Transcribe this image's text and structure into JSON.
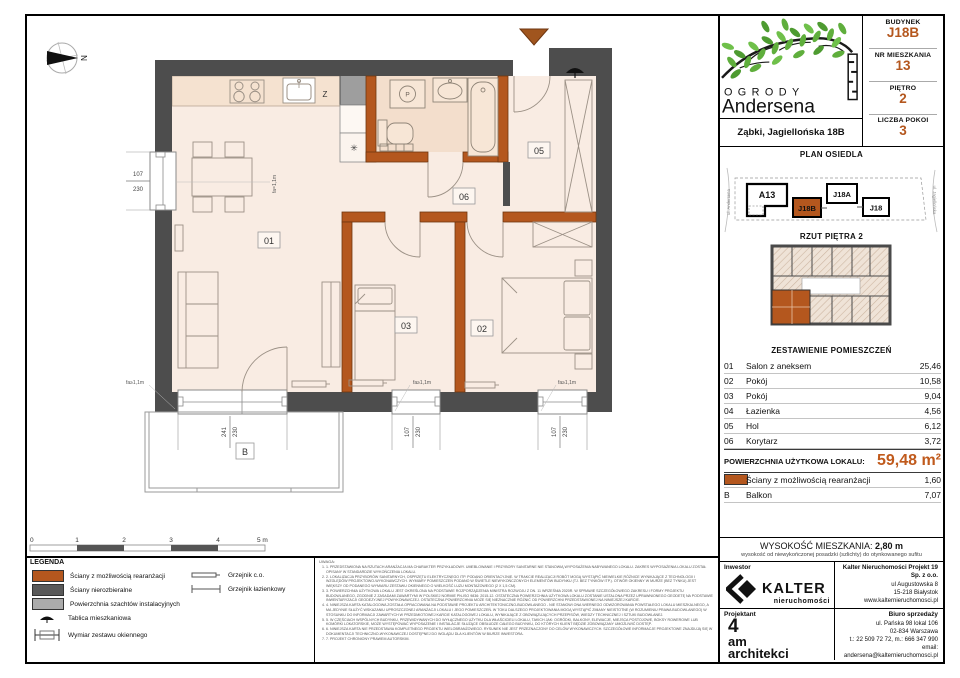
{
  "colors": {
    "accent_orange": "#B4571E",
    "total_orange": "#C05A1C",
    "wall_dark": "#4D4D4D",
    "shaft_gray": "#9E9E9E",
    "floor": "#F9ECE3",
    "bathroom_floor": "#F3DECC",
    "leaf_green": "#5FAE3C"
  },
  "header": {
    "budynek_label": "BUDYNEK",
    "budynek_value": "J18B",
    "nr_label": "NR MIESZKANIA",
    "nr_value": "13",
    "pietro_label": "PIĘTRO",
    "pietro_value": "2",
    "pokoi_label": "LICZBA POKOI",
    "pokoi_value": "3"
  },
  "brand": {
    "line1": "OGRODY",
    "line2": "Andersena",
    "address": "Ząbki, Jagiellońska 18B"
  },
  "site_plan": {
    "title": "PLAN OSIEDLA",
    "street_left": "ul. Andersena",
    "street_right": "ul. Jagiellońska",
    "buildings": [
      "A13",
      "J18B",
      "J18A",
      "J18"
    ],
    "highlighted": "J18B"
  },
  "floor_thumb": {
    "title": "RZUT PIĘTRA 2"
  },
  "rooms_table": {
    "title": "ZESTAWIENIE POMIESZCZEŃ",
    "rows": [
      {
        "no": "01",
        "name": "Salon z aneksem",
        "area": "25,46"
      },
      {
        "no": "02",
        "name": "Pokój",
        "area": "10,58"
      },
      {
        "no": "03",
        "name": "Pokój",
        "area": "9,04"
      },
      {
        "no": "04",
        "name": "Łazienka",
        "area": "4,56"
      },
      {
        "no": "05",
        "name": "Hol",
        "area": "6,12"
      },
      {
        "no": "06",
        "name": "Korytarz",
        "area": "3,72"
      }
    ],
    "total_label": "POWIERZCHNIA UŻYTKOWA LOKALU:",
    "total_value": "59,48 m²",
    "extra": [
      {
        "no": "",
        "name": "Ściany z możliwością rearanżacji",
        "area": "1,60"
      },
      {
        "no": "B",
        "name": "Balkon",
        "area": "7,07"
      }
    ]
  },
  "height_info": {
    "label": "WYSOKOŚĆ MIESZKANIA:",
    "value": "2,80 m",
    "note": "wysokość od niewykończonej posadzki (szlichty) do otynkowanego sufitu"
  },
  "inwestor": {
    "label": "Inwestor",
    "brand": "KALTER",
    "brand_sub": "nieruchomości",
    "company": "Kalter Nieruchomości Projekt 19 Sp. z o.o.",
    "address1": "ul Augustowska 8",
    "address2": "15-218 Białystok",
    "web": "www.kalternieruchomosci.pl"
  },
  "projektant": {
    "label": "Projektant",
    "line1": "4",
    "line2": "am",
    "line3": "architekci"
  },
  "sales": {
    "label": "Biuro sprzedaży",
    "address1": "ul. Pańska 98 lokal 106",
    "address2": "02-834 Warszawa",
    "phone": "t.: 22 509 72 72, m.: 666 347 990",
    "email": "email: andersena@kalternieruchomosci.pl"
  },
  "legend": {
    "title": "LEGENDA",
    "items": [
      "Ściany z możliwością rearanżacji",
      "Ściany nierozbieralne",
      "Powierzchnia szachtów instalacyjnych",
      "Tablica mieszkaniowa",
      "Wymiar zestawu okiennego"
    ],
    "items2": [
      "Grzejnik c.o.",
      "Grzejnik łazienkowy"
    ]
  },
  "scale_bar": {
    "labels": [
      "0",
      "1",
      "2",
      "3",
      "4",
      "5 m"
    ]
  },
  "notes": {
    "title": "UWAGA:",
    "items": [
      "1.  PRZEDSTAWIONA NA RZUTACH ARANŻACJA MA CHARAKTER PRZYKŁADOWY. UMEBLOWANIE I PRZYBORY SANITARNE NIE STANOWIĄ WYPOSAŻENIA NABYWANEGO LOKALU. ZAKRES WYPOSAŻENIA LOKALU ZOSTAŁ OPISANY W STANDARDZIE WYKOŃCZENIA LOKALU.",
      "2.  LOKALIZACJA PRZYBORÓW SANITARNYCH, OSPRZĘTU ELEKTRYCZNEGO ITP. PODANO ORIENTACYJNIE. W TRAKCIE REALIZACJI ROBÓT MOGĄ WYSTĄPIĆ NIEWIELKIE RÓŻNICE WYNIKAJĄCE Z TECHNOLOGII I WZGLĘDÓW PROJEKTOWO-WYKONAWCZYCH. WYMIARY POMIESZCZEŃ PODANO W ŚWIETLE NIEWYKOŃCZONYCH ELEMENTÓW BUDYNKU (TJ. BEZ TYNKÓW ITP.). OTWÓR OKIENNY W MURZE (BEZ TYNKU) JEST WIĘKSZY OD PODANEGO WYMIARU ZESTAWU OKIENNEGO O WIELKOŚĆ LUZU MONTAŻOWEGO (2 X 1,5 CM).",
      "3.  POWIERZCHNIA UŻYTKOWA LOKALU JEST OKREŚLONA NA PODSTAWIE ROZPORZĄDZENIA MINISTRA ROZWOJU Z DN. 11 WRZEŚNIA 2020R. W SPRAWIE SZCZEGÓŁOWEGO ZAKRESU I FORMY PROJEKTU BUDOWLANEGO, ZGODNIE Z ZASADAMI ZAWARTYMI W POLSKIEJ NORMIE PN-ISO 9836: 2015-12. OSTATECZNA POWIERZCHNIA UŻYTKOWA LOKALU ZOSTANIE USTALONA PRZEZ UPRAWNIONEGO GEODETĘ NA PODSTAWIE INWENTARYZACJI GEODEZYJNEJ POWYKONAWCZEJ. OSTATECZNA POWIERZCHNIA MOŻE SIĘ NIEZNACZNIE RÓŻNIĆ OD POWIERZCHNI PRZEDSTAWIONEJ NA NINIEJSZEJ KARCIE.",
      "4.  NINIEJSZA KARTA KATALOGOWA ZOSTAŁA OPRACOWANA NA PODSTAWIE PROJEKTU ARCHITEKTONICZNO-BUDOWLANEGO - NIE STANOWI ONA WIERNEGO ODWZOROWANIA POWSTAŁEGO LOKALU MIESZKALNEGO, A MA JEDYNIE SŁUŻYĆ WSKAZANIU UPROSZCZONEJ ARANŻACJI LOKALU I JEGO POMIESZCZEŃ. W TOKU DALSZEGO PROJEKTOWANIA MOGĄ WYSTĄPIĆ ZMIANY NIEISTOTNE (W ROZUMIENIU PRAWA BUDOWLANEGO) W STOSUNKU DO INFORMACJI ZAWARTYCH W PRZEDMIOTOWEJ KARCIE KATALOGOWEJ LOKALU, WYNIKAJĄCE Z OBOWIĄZUJĄCYCH PRZEPISÓW, WIEDZY TECHNICZNEJ I SZTUKI BUDOWLANEJ.",
      "5.  W CZĘŚCIACH WSPÓLNYCH BUDYNKU, PRZEWIDYWANYCH DO WYŁĄCZNEGO UŻYTKU DLA WŁAŚCICIELI LOKALU, TAKICH JAK: OGRÓDKI, BALKONY, ELEWACJE, MIEJSCA POSTOJOWE, BOKSY ROWEROWE LUB KOMÓRKI LOKATORSKIE, MOŻE WYSTĘPOWAĆ WYPOSAŻENIE I INSTALACJE SŁUŻĄCE OBSŁUDZE CAŁEGO BUDYNKU, DO KTÓRYCH KLIENT BĘDZIE ZOBOWIĄZANY UMOŻLIWIĆ DOSTĘP.",
      "6.  NINIEJSZA KARTA NIE PRZEDSTAWIA KOMPLETNEGO PROJEKTU WIELOBRANŻOWEGO. RYSUNEK NIE JEST PRZEZNACZONY DO CELÓW WYKONAWCZYCH. SZCZEGÓŁOWE INFORMACJE PROJEKTOWE ZNAJDUJĄ SIĘ W DOKUMENTACJI TECHNICZNO-WYKONAWCZEJ DOSTĘPNEJ DO WGLĄDU DLA KLIENTÓW W BIURZE INWESTORA.",
      "7.  PROJEKT CHRONIONY PRAWEM AUTORSKIM."
    ]
  },
  "plan": {
    "labels": {
      "r01": "01",
      "r02": "02",
      "r03": "03",
      "r05": "05",
      "r06": "06",
      "balcony": "B"
    },
    "marks": {
      "kitchen": "Z",
      "washer": "P",
      "north": "N",
      "vent": "✳"
    },
    "dims": {
      "left": {
        "w": "107",
        "h": "230"
      },
      "w1": {
        "w": "241",
        "h": "230"
      },
      "w2": {
        "w": "107",
        "h": "230"
      },
      "w3": {
        "w": "107",
        "h": "230"
      }
    },
    "window_labels": {
      "left": "fa=1,1m",
      "bottom": "fa≥1,1m"
    }
  }
}
